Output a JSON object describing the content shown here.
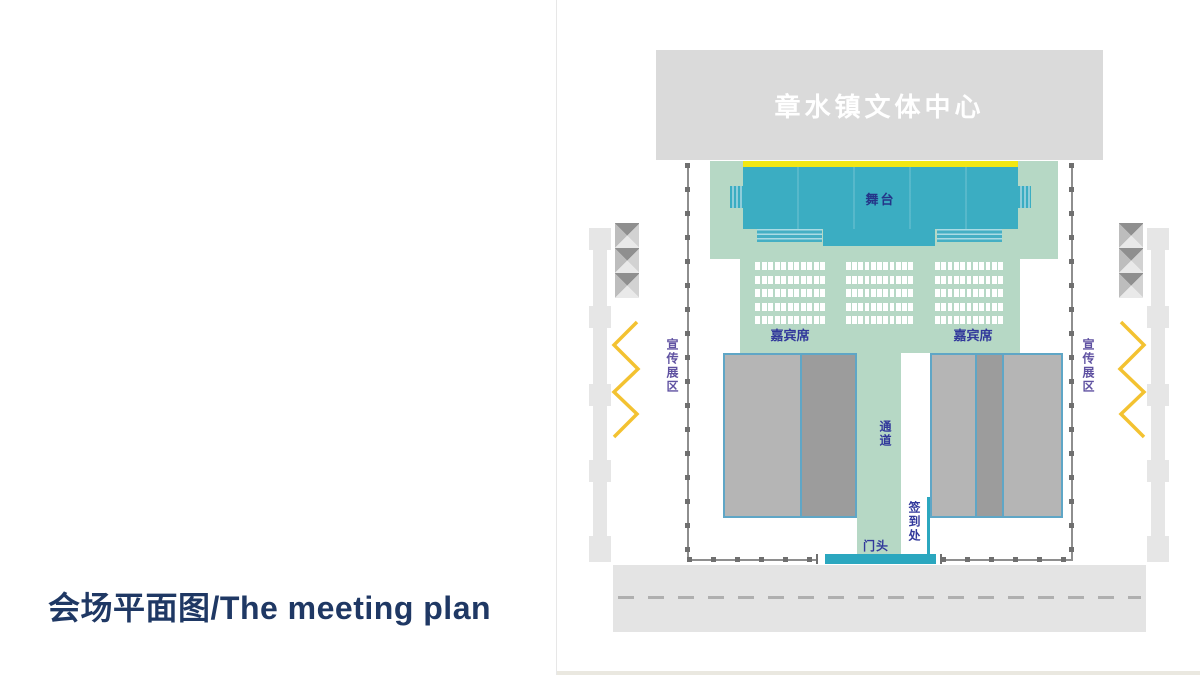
{
  "slide": {
    "title": "会场平面图/The meeting plan"
  },
  "plan": {
    "building_label": "章水镇文体中心",
    "stage_label": "舞台",
    "guest_seats_label": "嘉宾席",
    "aisle_label": "通道",
    "signin_label": "签到处",
    "entrance_label": "门头",
    "promo_zone_label": "宣传展区",
    "seat_grid": {
      "columns": 3,
      "rows_per_column": 5,
      "seats_per_row": 11
    },
    "colors": {
      "hall_mint_green": "#B6D8C5",
      "stage_teal": "#3BADC2",
      "entrance_teal": "#2BA7BF",
      "stage_edge_yellow": "#F2E713",
      "zigzag_gold": "#F3C231",
      "banner_gray": "#DADADA",
      "audience_block_light": "#B5B5B5",
      "audience_block_dark": "#9C9C9C",
      "block_border_blue": "#5FA6C6",
      "boundary_dot_gray": "#6F6F6F",
      "label_navy": "#31389B",
      "promo_purple": "#5F51A1",
      "title_navy": "#1F3864"
    }
  }
}
